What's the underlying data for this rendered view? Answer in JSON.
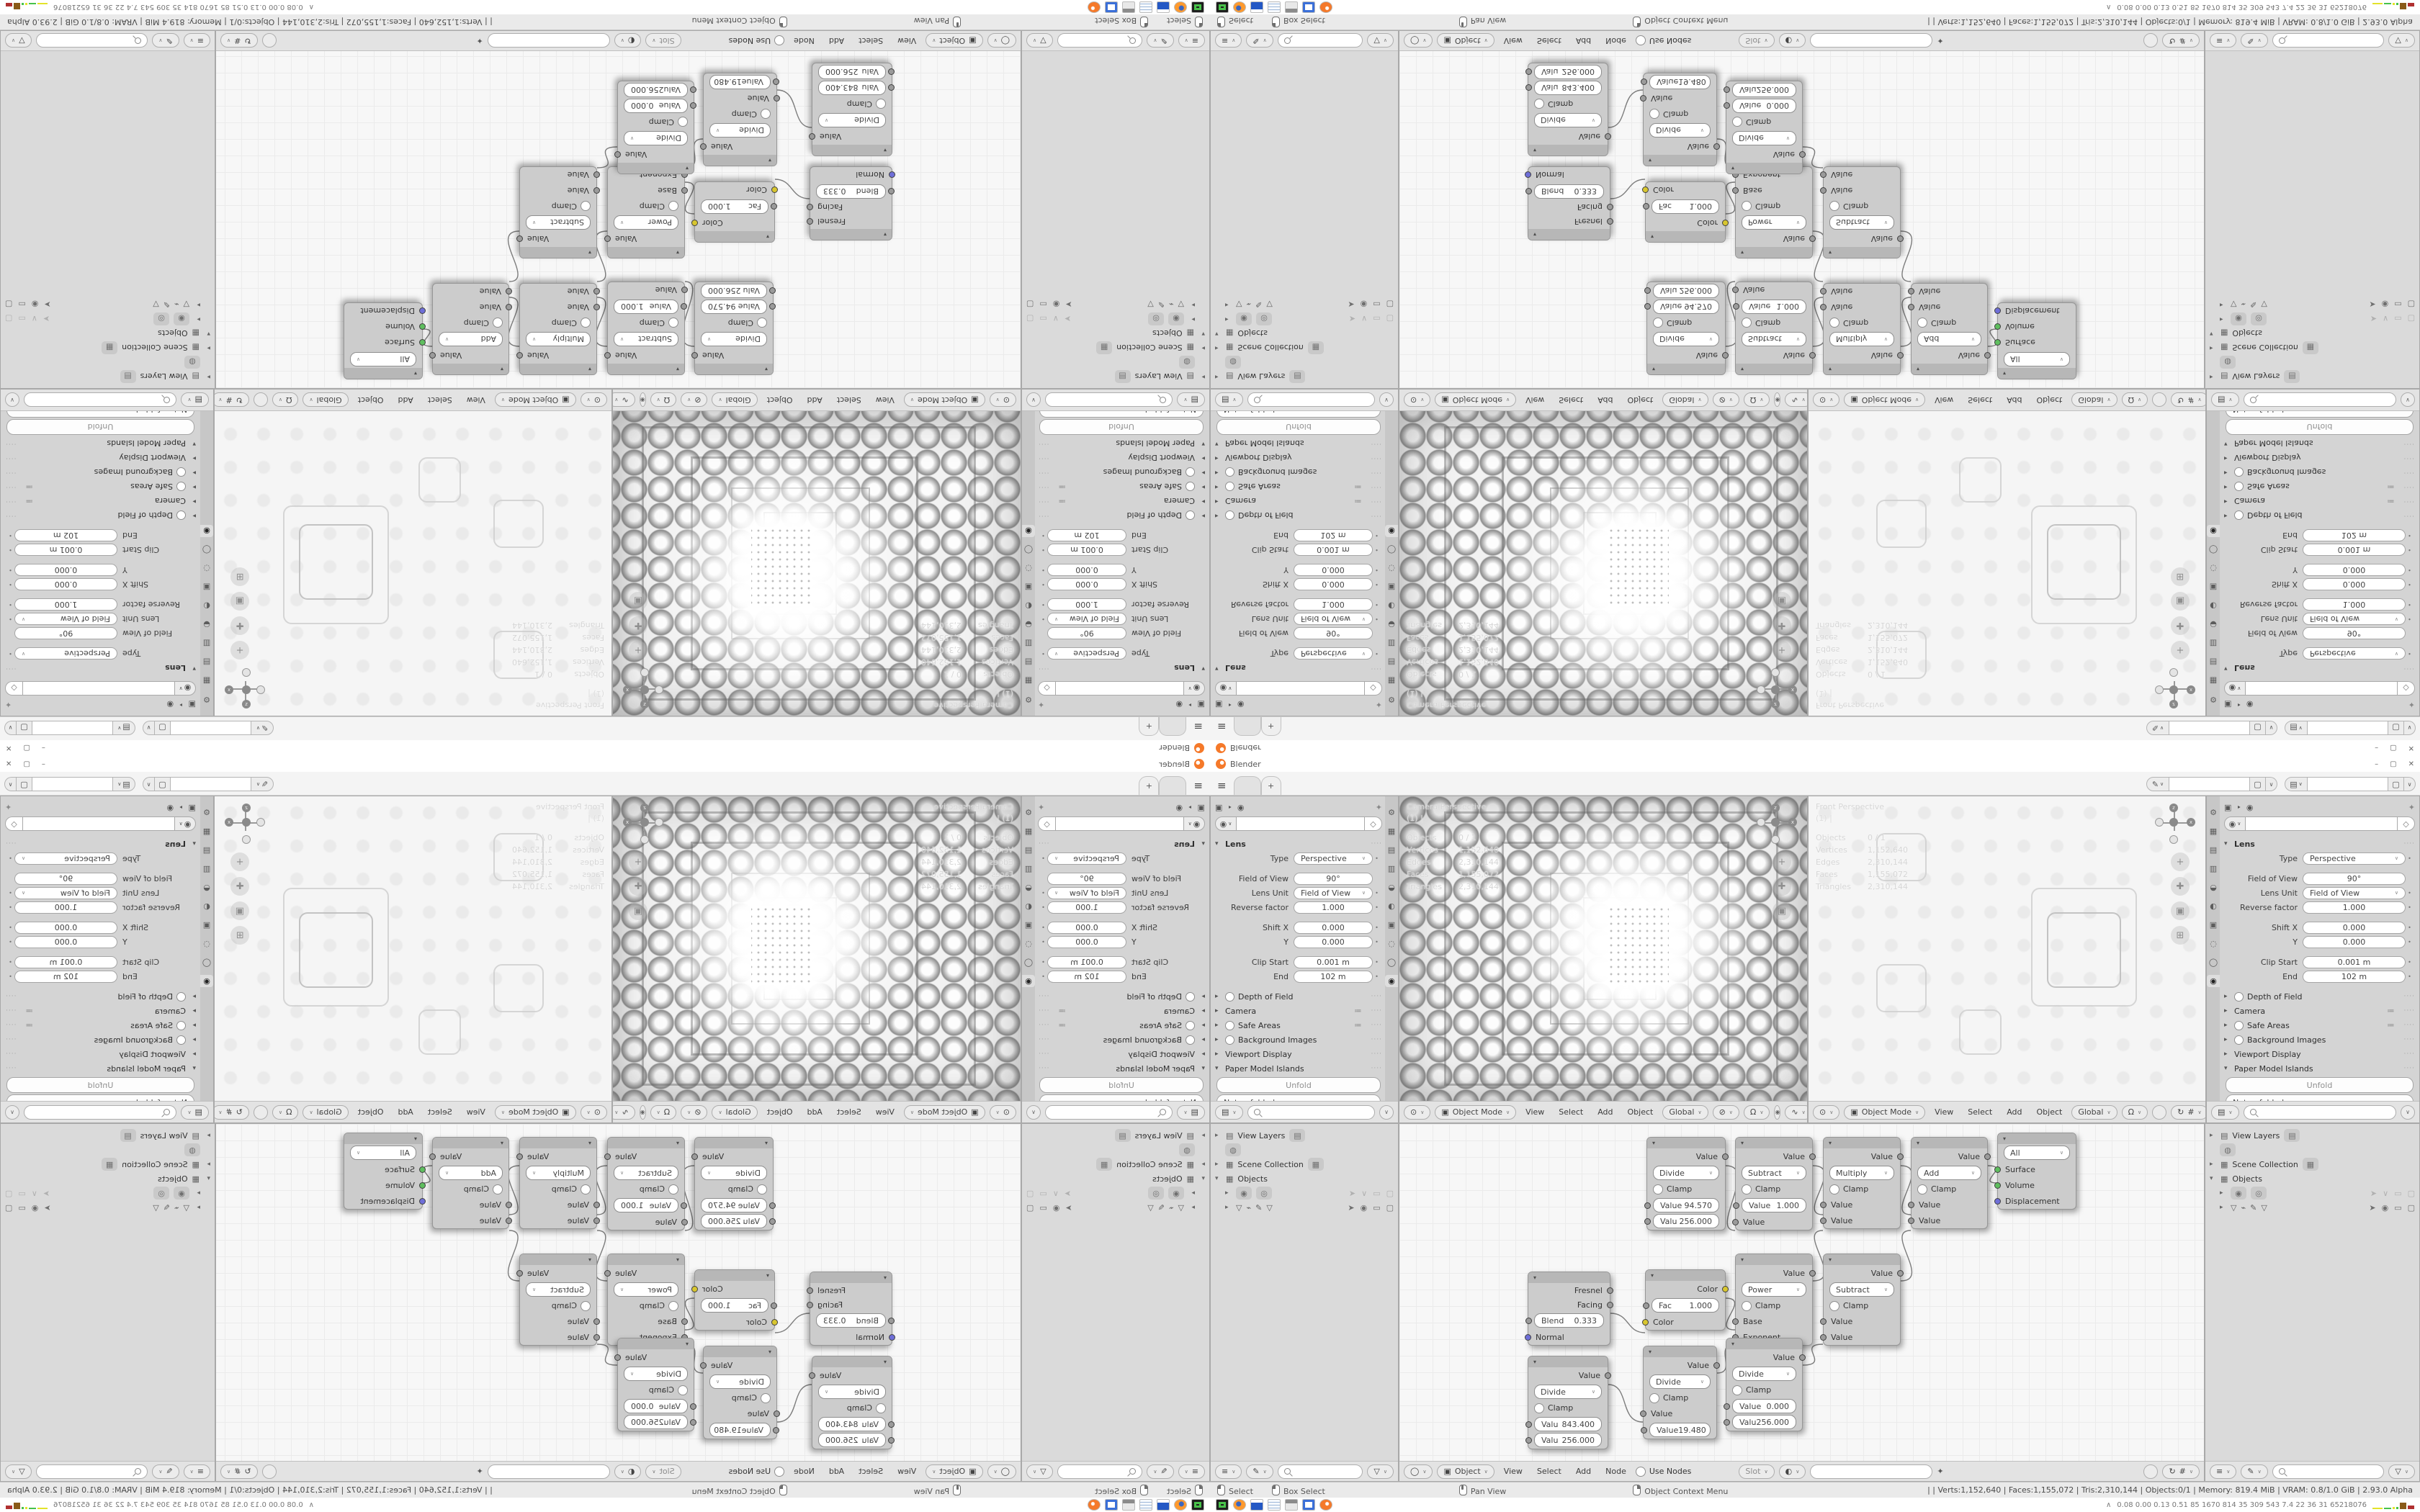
{
  "titlebar": {
    "app_name": "Blender",
    "minimize": "–",
    "maximize": "▢",
    "close": "✕"
  },
  "topbar": {
    "new_tab_label": "+"
  },
  "idbar": {
    "field1": "",
    "field2": ""
  },
  "props": {
    "lens_title": "Lens",
    "type_label": "Type",
    "type_value": "Perspective",
    "fov_label": "Field of View",
    "fov_value": "90°",
    "unit_label": "Lens Unit",
    "unit_value": "Field of View",
    "reverse_label": "Reverse factor",
    "reverse_value": "1.000",
    "shiftx_label": "Shift X",
    "shiftx_value": "0.000",
    "shifty_label": "Y",
    "shifty_value": "0.000",
    "clip_label": "Clip Start",
    "clip_value": "0.001 m",
    "end_label": "End",
    "end_value": "102 m",
    "sections": [
      "Depth of Field",
      "Camera",
      "Safe Areas",
      "Background Images",
      "Viewport Display"
    ],
    "paper_title": "Paper Model Islands",
    "unfold_button": "Unfold",
    "unfold_status": "Not unfolded",
    "custom_props": "Custom Properties",
    "tab_icons": [
      "tool",
      "render",
      "output",
      "view-layer",
      "scene",
      "world",
      "object",
      "modifiers",
      "physics",
      "object-data"
    ]
  },
  "viewports": {
    "cam": {
      "name": "Camera Perspective",
      "subtitle": "(1) |"
    },
    "front": {
      "name": "Front Perspective",
      "subtitle": "(1) |"
    },
    "stats": {
      "objects_l": "Objects",
      "objects": "0 / 1",
      "verts_l": "Vertices",
      "verts": "1,152,640",
      "edges_l": "Edges",
      "edges": "2,310,144",
      "faces_l": "Faces",
      "faces": "1,155,072",
      "tris_l": "Triangles",
      "tris": "2,310,144"
    },
    "gizmo": {
      "z": "z",
      "x": "x"
    }
  },
  "vp_header": {
    "mode": "Object Mode",
    "menu_view": "View",
    "menu_select": "Select",
    "menu_add": "Add",
    "menu_object": "Object",
    "orientation": "Global"
  },
  "outliner": {
    "view_layers": "View Layers",
    "scene_collection": "Scene Collection",
    "objects": "Objects"
  },
  "node_editor": {
    "header": {
      "object": "Object",
      "menu_view": "View",
      "menu_select": "Select",
      "menu_add": "Add",
      "menu_node": "Node",
      "use_nodes": "Use Nodes",
      "slot": "Slot"
    },
    "nodes": {
      "divide1": {
        "out": "Value",
        "op": "Divide",
        "clamp": "Clamp",
        "in1_label": "Value",
        "in1_value": "94.570",
        "in2_label": "Valu",
        "in2_value": "256.000"
      },
      "subtract1": {
        "out": "Value",
        "op": "Subtract",
        "clamp": "Clamp",
        "in1_label": "Value",
        "in1_value": "1.000",
        "in2_label": "Value"
      },
      "multiply1": {
        "out": "Value",
        "op": "Multiply",
        "clamp": "Clamp",
        "in1_label": "Value",
        "in2_label": "Value"
      },
      "add1": {
        "out": "Value",
        "op": "Add",
        "clamp": "Clamp",
        "in1_label": "Value",
        "in2_label": "Value"
      },
      "output": {
        "target": "All",
        "surface": "Surface",
        "volume": "Volume",
        "displacement": "Displacement"
      },
      "layer_weight": {
        "out1": "Fresnel",
        "out2": "Facing",
        "blend_label": "Blend",
        "blend_value": "0.333",
        "normal": "Normal"
      },
      "invert": {
        "out": "Color",
        "fac_label": "Fac",
        "fac_value": "1.000",
        "in": "Color"
      },
      "power": {
        "out": "Value",
        "op": "Power",
        "clamp": "Clamp",
        "in1_label": "Base",
        "in2_label": "Exponent"
      },
      "subtract2": {
        "out": "Value",
        "op": "Subtract",
        "clamp": "Clamp",
        "in1_label": "Value",
        "in2_label": "Value"
      },
      "divide2": {
        "out": "Value",
        "op": "Divide",
        "clamp": "Clamp",
        "in1_label": "Valu",
        "in1_value": "843.400",
        "in2_label": "Valu",
        "in2_value": "256.000"
      },
      "divide3": {
        "out": "Value",
        "op": "Divide",
        "clamp": "Clamp",
        "in1_label": "Value",
        "in2_label": "Value",
        "in2_value": "19.480"
      },
      "divide4": {
        "out": "Value",
        "op": "Divide",
        "clamp": "Clamp",
        "in1_label": "Value",
        "in1_value": "0.000",
        "in2_label": "Valu",
        "in2_value": "256.000"
      }
    }
  },
  "statusbar": {
    "select": "Select",
    "box_select": "Box Select",
    "pan": "Pan View",
    "context": "Object Context Menu",
    "stats": "|   | Verts:1,152,640 | Faces:1,155,072 | Tris:2,310,144 | Objects:0/1 | Memory: 819.4 MiB | VRAM: 0.8/1.0 GiB | 2.93.0 Alpha"
  },
  "taskbar": {
    "app_icons": [
      "terminal",
      "firefox",
      "save",
      "notepad",
      "window",
      "image-viewer",
      "blender"
    ],
    "bench_values": "0.08 0.00 0.13 0.51   85   1670 814   35   309   543   7.4   22   36   31   65218076"
  }
}
